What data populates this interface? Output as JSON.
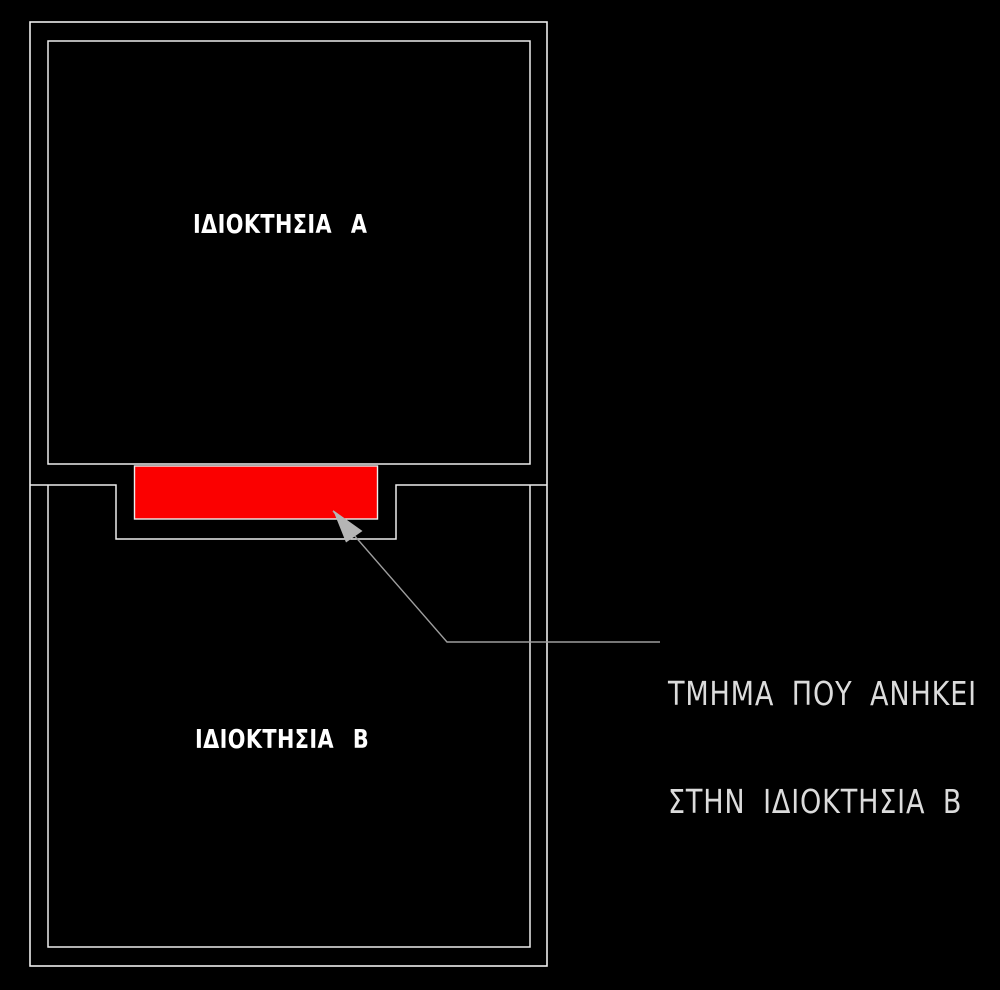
{
  "drawing": {
    "colors": {
      "background": "#000000",
      "line": "#ededed",
      "leader": "#9e9e9e",
      "arrowhead": "#b5b5b5",
      "highlight": "#fb0000",
      "label": "#ffffff",
      "annotation": "#dcdcdc"
    },
    "labels": {
      "property_a": "ΙΔΙΟΚΤΗΣΙΑ Α",
      "property_b": "ΙΔΙΟΚΤΗΣΙΑ Β"
    },
    "annotation": {
      "line1": "ΤΜΗΜΑ ΠΟΥ ΑΝΗΚΕΙ",
      "line2": "ΣΤΗΝ ΙΔΙΟΚΤΗΣΙΑ Β"
    }
  }
}
